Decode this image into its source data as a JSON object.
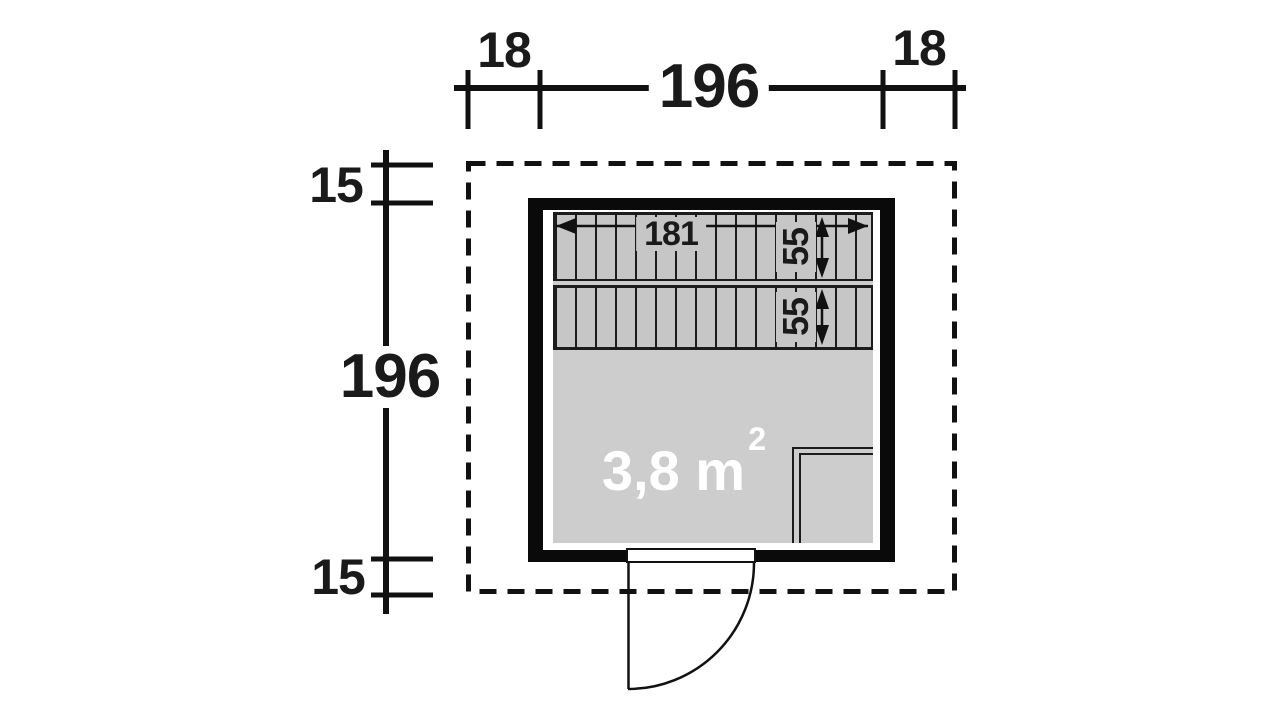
{
  "plan": {
    "type": "sauna-floor-plan",
    "outer_width_dim": {
      "left_overhang": "18",
      "span": "196",
      "right_overhang": "18"
    },
    "outer_height_dim": {
      "top_overhang": "15",
      "span": "196",
      "bottom_overhang": "15"
    },
    "bench": {
      "length": "181",
      "upper_depth": "55",
      "lower_depth": "55"
    },
    "floor_area": {
      "value": "3,8 m",
      "superscript": "2"
    },
    "colors": {
      "wall": "#0a0a0a",
      "floor": "#cdcdcd",
      "bench": "#c6c6c6",
      "line": "#111111",
      "area_text": "#ffffff",
      "background": "#ffffff"
    }
  }
}
